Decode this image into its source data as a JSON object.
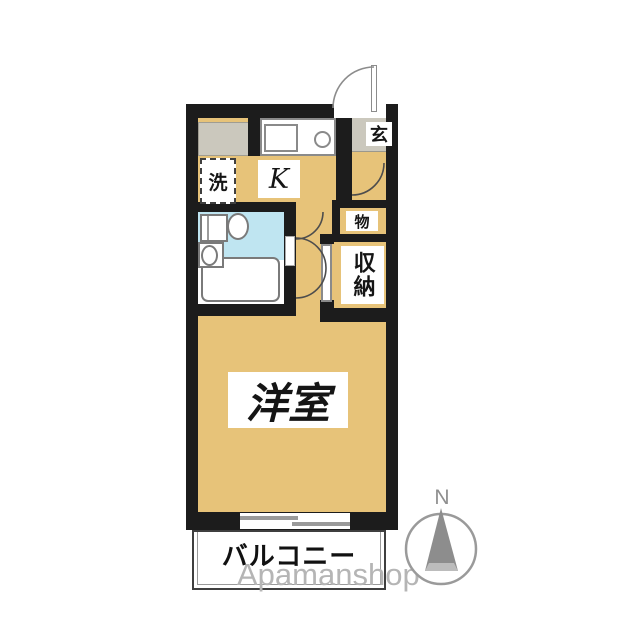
{
  "floorplan": {
    "labels": {
      "entrance": "玄",
      "kitchen": "K",
      "laundry": "洗",
      "cupboard": "物",
      "closet": "収納",
      "room": "洋室",
      "balcony": "バルコニー"
    },
    "compass_north": "N",
    "watermark": "Apamanshop",
    "colors": {
      "floor_tan": "#e7c379",
      "tile_gray": "#cbc8bd",
      "bath_blue": "#bfe5f1",
      "wall_black": "#1c1c1c",
      "watermark_gray": "#b5b5b5"
    }
  }
}
